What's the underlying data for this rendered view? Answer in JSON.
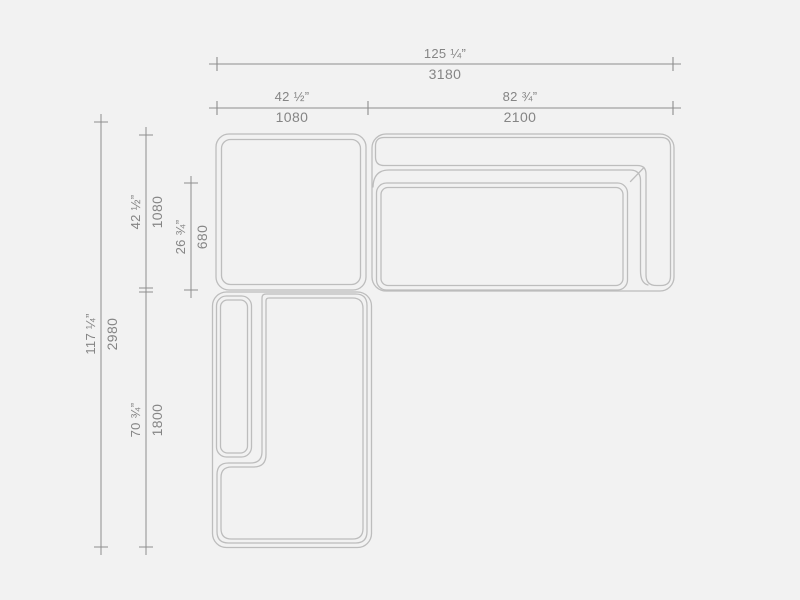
{
  "drawing": {
    "type": "sofa-top-view-dimension-drawing",
    "units": [
      "inches",
      "mm"
    ]
  },
  "colors": {
    "background": "#f2f2f2",
    "furniture_outline": "#bdbdbd",
    "dimension_line": "#8e8e8e",
    "label_text": "#858585"
  },
  "dimensions": {
    "top": [
      {
        "name": "overall-width",
        "inches": "125 ¼”",
        "mm": "3180"
      },
      {
        "name": "corner-module-width",
        "inches": "42 ½”",
        "mm": "1080"
      },
      {
        "name": "sofa-module-width",
        "inches": "82 ¾”",
        "mm": "2100"
      }
    ],
    "left": [
      {
        "name": "overall-depth",
        "inches": "117 ¼”",
        "mm": "2980"
      },
      {
        "name": "corner-module-depth",
        "inches": "42 ½”",
        "mm": "1080"
      },
      {
        "name": "seat-depth",
        "inches": "26 ¾”",
        "mm": "680"
      },
      {
        "name": "chaise-module-length",
        "inches": "70 ¾”",
        "mm": "1800"
      }
    ]
  }
}
